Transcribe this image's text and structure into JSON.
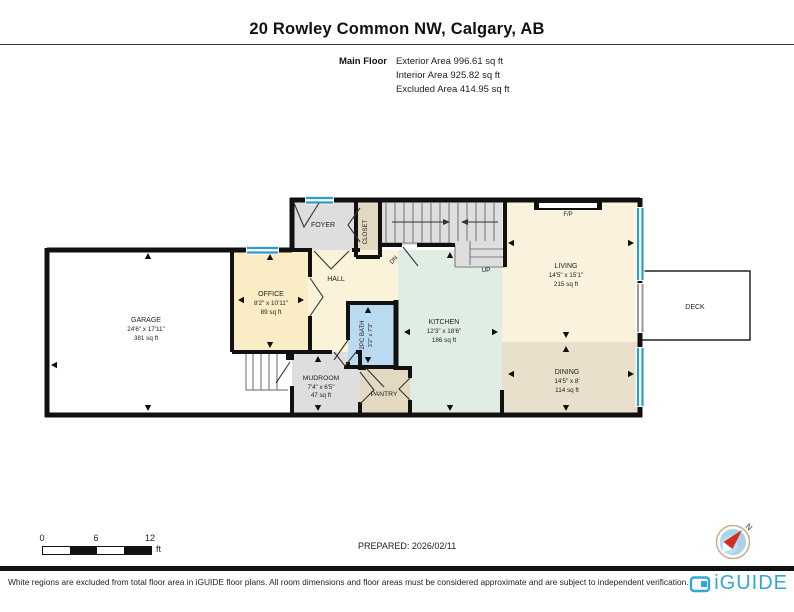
{
  "header": {
    "title": "20 Rowley Common NW, Calgary, AB",
    "floor_label": "Main Floor",
    "areas": [
      "Exterior Area 996.61 sq ft",
      "Interior Area 925.82 sq ft",
      "Excluded Area 414.95 sq ft"
    ]
  },
  "rooms": {
    "garage": {
      "name": "GARAGE",
      "dims": "24'6\" x 17'11\"",
      "area": "381 sq ft"
    },
    "office": {
      "name": "OFFICE",
      "dims": "8'2\" x 10'11\"",
      "area": "89 sq ft"
    },
    "foyer": {
      "name": "FOYER"
    },
    "closet": {
      "name": "CLOSET"
    },
    "hall": {
      "name": "HALL"
    },
    "kitchen": {
      "name": "KITCHEN",
      "dims": "12'3\" x 18'6\"",
      "area": "186 sq ft"
    },
    "living": {
      "name": "LIVING",
      "dims": "14'5\" x 15'1\"",
      "area": "215 sq ft"
    },
    "dining": {
      "name": "DINING",
      "dims": "14'5\" x 8'",
      "area": "114 sq ft"
    },
    "mudroom": {
      "name": "MUDROOM",
      "dims": "7'4\" x 6'5\"",
      "area": "47 sq ft"
    },
    "pantry": {
      "name": "PANTRY"
    },
    "bath": {
      "name": "2PC BATH",
      "dims": "3'2\" x 7'3\""
    },
    "deck": {
      "name": "DECK"
    },
    "fireplace": {
      "name": "F/P"
    },
    "stairs_up": "UP",
    "stairs_dn": "DN"
  },
  "scale": {
    "tick0": "0",
    "tick1": "6",
    "tick2": "12",
    "unit": "ft"
  },
  "prepared": "PREPARED: 2026/02/11",
  "compass": {
    "north": "N"
  },
  "footer": {
    "disclaimer": "White regions are excluded from total floor area in iGUIDE floor plans. All room dimensions and floor areas must be considered approximate and are subject to independent verification.",
    "brand": "iGUIDE"
  },
  "colors": {
    "wall": "#111111",
    "window_blue": "#2E9BC8",
    "bath_blue": "#BADAEF",
    "kitchen_mint": "#E0EDE3",
    "cream": "#FAF2DC",
    "office_cream": "#FAECC5",
    "dining_tan": "#E9E0CC",
    "pantry_tan": "#E3D9C2",
    "gray": "#DEDEDE",
    "brand_blue": "#2FA8D8",
    "compass_red": "#D42B1E"
  }
}
